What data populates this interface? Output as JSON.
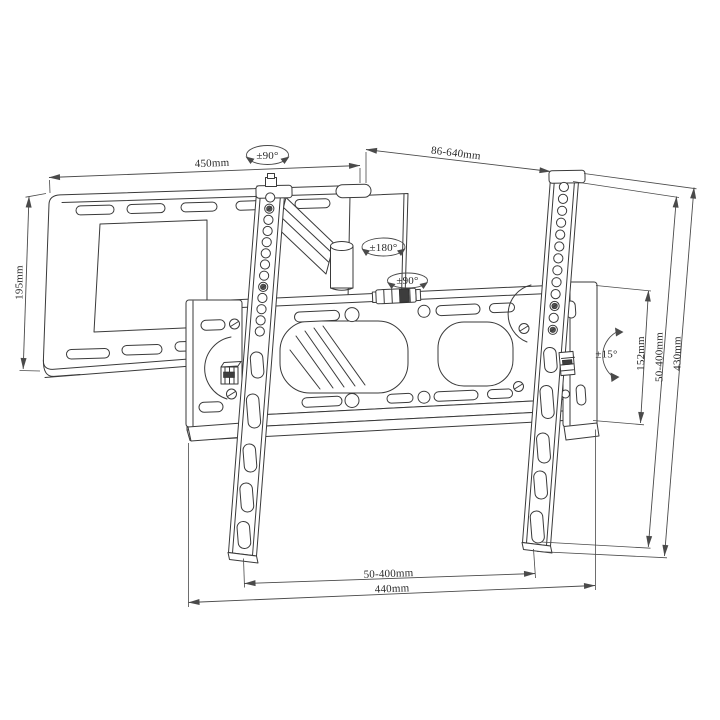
{
  "diagram": {
    "kind": "technical-drawing",
    "subject": "articulating TV wall mount bracket",
    "colors": {
      "background": "#ffffff",
      "line": "#3a3a3a",
      "dimension": "#4a4a4a"
    },
    "labels": {
      "wall_plate_width": "450mm",
      "wall_plate_height": "195mm",
      "swivel_wall": "±90°",
      "extension_range": "86-640mm",
      "swivel_elbow": "±180°",
      "swivel_bracket": "±90°",
      "tilt_range": "±15°",
      "side_plate_height": "152mm",
      "vesa_vertical_range": "50-400mm",
      "rail_length": "430mm",
      "vesa_horizontal_range": "50-400mm",
      "beam_width": "440mm"
    }
  }
}
